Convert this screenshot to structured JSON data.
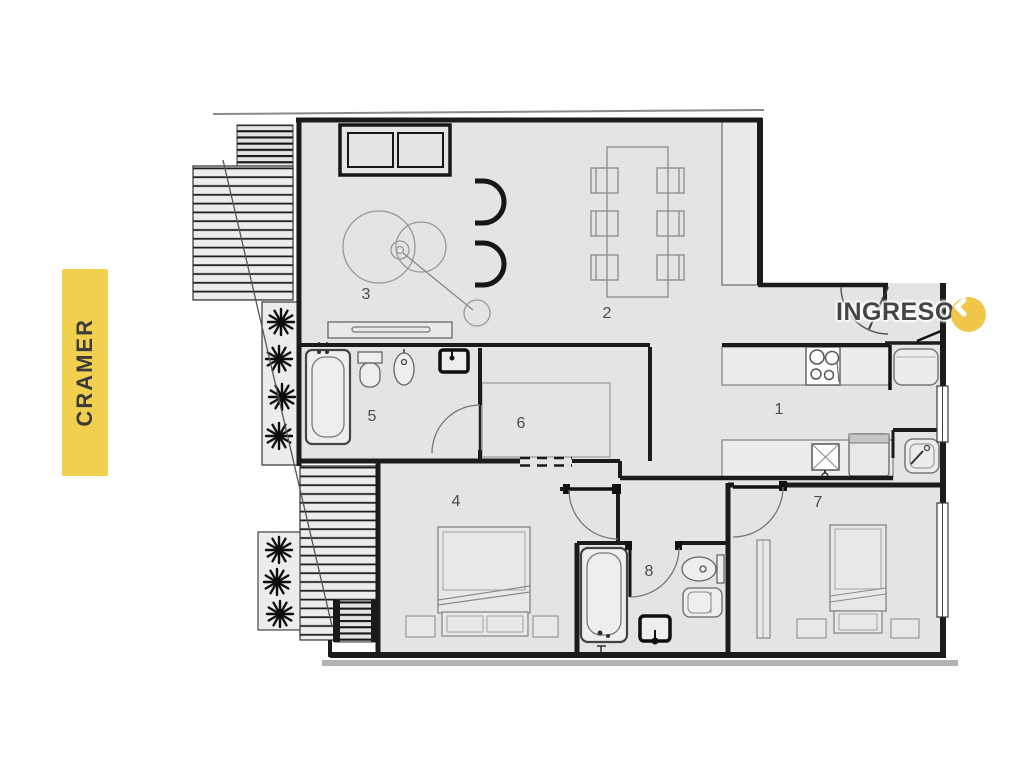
{
  "side_label": {
    "text": "CRAMER"
  },
  "entry": {
    "label": "INGRESO",
    "icon": "chevron-left-icon"
  },
  "rooms": [
    {
      "number": "1",
      "name": "kitchen"
    },
    {
      "number": "2",
      "name": "dining"
    },
    {
      "number": "3",
      "name": "living"
    },
    {
      "number": "4",
      "name": "bedroom-1"
    },
    {
      "number": "5",
      "name": "bathroom-1"
    },
    {
      "number": "6",
      "name": "hall"
    },
    {
      "number": "7",
      "name": "bedroom-2"
    },
    {
      "number": "8",
      "name": "bathroom-2"
    }
  ],
  "colors": {
    "accent_yellow": "#F2D04F",
    "accent_circle": "#F0C64B",
    "wall": "#1b1b1b",
    "floor_fill": "#e4e4e4",
    "room_number": "#4c4c4c"
  }
}
